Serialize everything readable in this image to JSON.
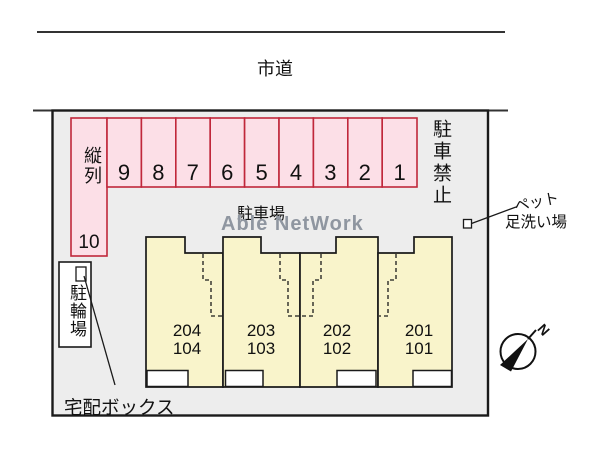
{
  "road": {
    "label": "市道"
  },
  "watermark": {
    "text": "Able NetWork",
    "color": "#8f96a0"
  },
  "parking": {
    "area_label": "駐車場",
    "no_parking_label": "駐車禁止",
    "tandem_label": "縦列",
    "tandem_number": "10",
    "stall_numbers": [
      "9",
      "8",
      "7",
      "6",
      "5",
      "4",
      "3",
      "2",
      "1"
    ],
    "stall_fill": "#fcdfe7",
    "stall_border": "#c0273b"
  },
  "building": {
    "units": [
      {
        "upper": "204",
        "lower": "104"
      },
      {
        "upper": "203",
        "lower": "103"
      },
      {
        "upper": "202",
        "lower": "102"
      },
      {
        "upper": "201",
        "lower": "101"
      }
    ],
    "fill": "#f9f4cb"
  },
  "bike_parking": {
    "label": "駐輪場"
  },
  "delivery_box": {
    "label": "宅配ボックス"
  },
  "pet_wash": {
    "label_line1": "ペット",
    "label_line2": "足洗い場"
  },
  "compass": {
    "label": "N"
  },
  "colors": {
    "site_fill": "#ededed",
    "outline": "#1a1a1a"
  }
}
